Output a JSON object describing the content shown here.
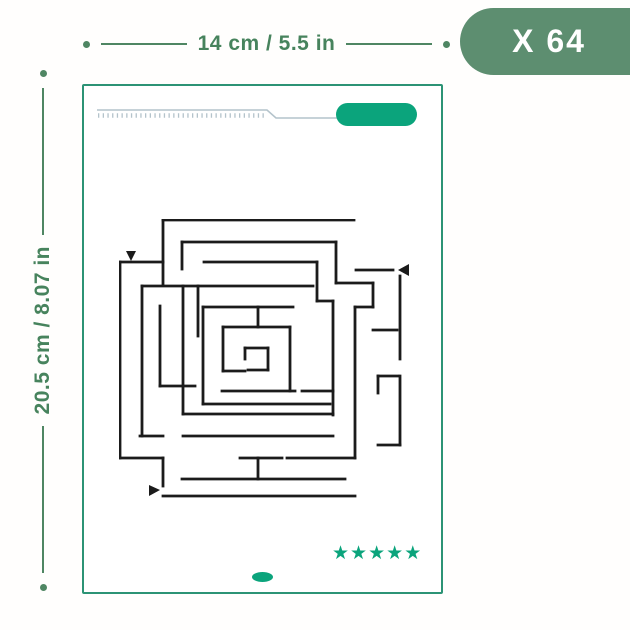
{
  "colors": {
    "dimension": "#47835d",
    "dimension_line": "#4f8663",
    "badge_bg": "#5d8e70",
    "badge_text": "#ffffff",
    "card_border": "#2c9375",
    "accent": "#0ba47c",
    "ruler": "#b4c3cb",
    "maze_stroke": "#1b1b1b"
  },
  "badge": {
    "label": "X 64"
  },
  "dimensions": {
    "width_label": "14 cm / 5.5 in",
    "height_label": "20.5 cm / 8.07 in"
  },
  "card": {
    "rating": {
      "star_count": 5,
      "star_glyph": "★"
    }
  },
  "maze": {
    "stroke_width": 2.8,
    "segments": [
      [
        44,
        1,
        235,
        1
      ],
      [
        44,
        1,
        44,
        66
      ],
      [
        63,
        23,
        217,
        23
      ],
      [
        63,
        23,
        63,
        50
      ],
      [
        217,
        23,
        217,
        64
      ],
      [
        1,
        43,
        44,
        43
      ],
      [
        1,
        43,
        1,
        239
      ],
      [
        85,
        43,
        198,
        43
      ],
      [
        198,
        43,
        198,
        82
      ],
      [
        198,
        82,
        214,
        82
      ],
      [
        214,
        82,
        214,
        196
      ],
      [
        237,
        51,
        274,
        51
      ],
      [
        281,
        57,
        281,
        140
      ],
      [
        217,
        64,
        254,
        64
      ],
      [
        254,
        64,
        254,
        88
      ],
      [
        236,
        88,
        254,
        88
      ],
      [
        236,
        88,
        236,
        239
      ],
      [
        254,
        111,
        278,
        111
      ],
      [
        23,
        67,
        194,
        67
      ],
      [
        23,
        67,
        23,
        217
      ],
      [
        64,
        67,
        64,
        195
      ],
      [
        79,
        67,
        79,
        117
      ],
      [
        41,
        87,
        41,
        167
      ],
      [
        41,
        167,
        76,
        167
      ],
      [
        84,
        88,
        174,
        88
      ],
      [
        84,
        88,
        84,
        185
      ],
      [
        139,
        88,
        139,
        108
      ],
      [
        104,
        108,
        171,
        108
      ],
      [
        104,
        108,
        104,
        152
      ],
      [
        104,
        152,
        126,
        152
      ],
      [
        171,
        108,
        171,
        172
      ],
      [
        126,
        129,
        149,
        129
      ],
      [
        126,
        129,
        126,
        140
      ],
      [
        149,
        129,
        149,
        151
      ],
      [
        129,
        151,
        149,
        151
      ],
      [
        103,
        172,
        176,
        172
      ],
      [
        183,
        172,
        214,
        172
      ],
      [
        84,
        185,
        211,
        185
      ],
      [
        64,
        195,
        214,
        195
      ],
      [
        259,
        157,
        279,
        157
      ],
      [
        259,
        157,
        259,
        174
      ],
      [
        281,
        157,
        281,
        226
      ],
      [
        259,
        226,
        281,
        226
      ],
      [
        21,
        217,
        44,
        217
      ],
      [
        64,
        217,
        214,
        217
      ],
      [
        1,
        239,
        44,
        239
      ],
      [
        44,
        239,
        44,
        267
      ],
      [
        121,
        239,
        163,
        239
      ],
      [
        168,
        239,
        236,
        239
      ],
      [
        139,
        239,
        139,
        260
      ],
      [
        63,
        260,
        226,
        260
      ],
      [
        44,
        277,
        236,
        277
      ]
    ],
    "arrows": [
      {
        "name": "maze-entry-arrow-down",
        "points": "7,32 17,32 12,42"
      },
      {
        "name": "maze-side-arrow-left",
        "points": "290,45 290,57 279,51"
      },
      {
        "name": "maze-exit-arrow-right",
        "points": "30,266 30,277 41,271"
      }
    ]
  }
}
